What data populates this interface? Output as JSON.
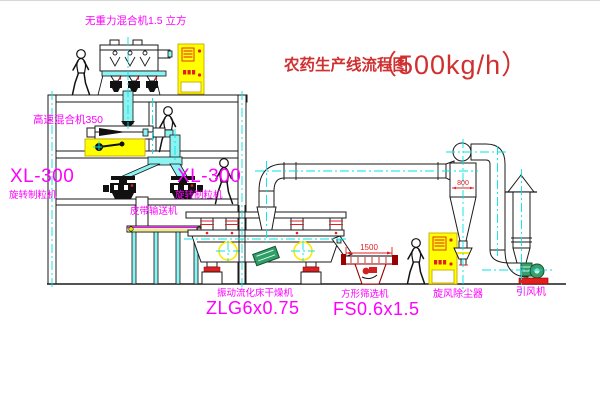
{
  "title": {
    "text": "农药生产线流程图",
    "capacity": "（500kg/h）"
  },
  "equipment": {
    "gravity_free_mixer": {
      "label": "无重力混合机1.5 立方"
    },
    "high_speed_mixer": {
      "label": "高速混合机350"
    },
    "granulator_left": {
      "model": "XL-300",
      "name": "旋转制粒机"
    },
    "granulator_right": {
      "model": "XL-300",
      "name": "旋转制粒机"
    },
    "belt_conveyor": {
      "name": "皮带输送机"
    },
    "fluid_bed_dryer": {
      "name": "振动流化床干燥机",
      "model": "ZLG6x0.75"
    },
    "square_sieve": {
      "name": "方形筛选机",
      "model": "FS0.6x1.5",
      "dimension": "1500"
    },
    "cyclone": {
      "name": "旋风除尘器",
      "dimension": "800"
    },
    "draft_fan": {
      "name": "引风机"
    }
  },
  "colors": {
    "label_magenta": "#ff00ff",
    "title_red": "#d03030",
    "dimension_red": "#e02020",
    "pipe_cyan": "#00e5e5",
    "cabinet_yellow": "#ffff00",
    "machine_green": "#2f9e68",
    "sieve_dark_red": "#990000"
  }
}
